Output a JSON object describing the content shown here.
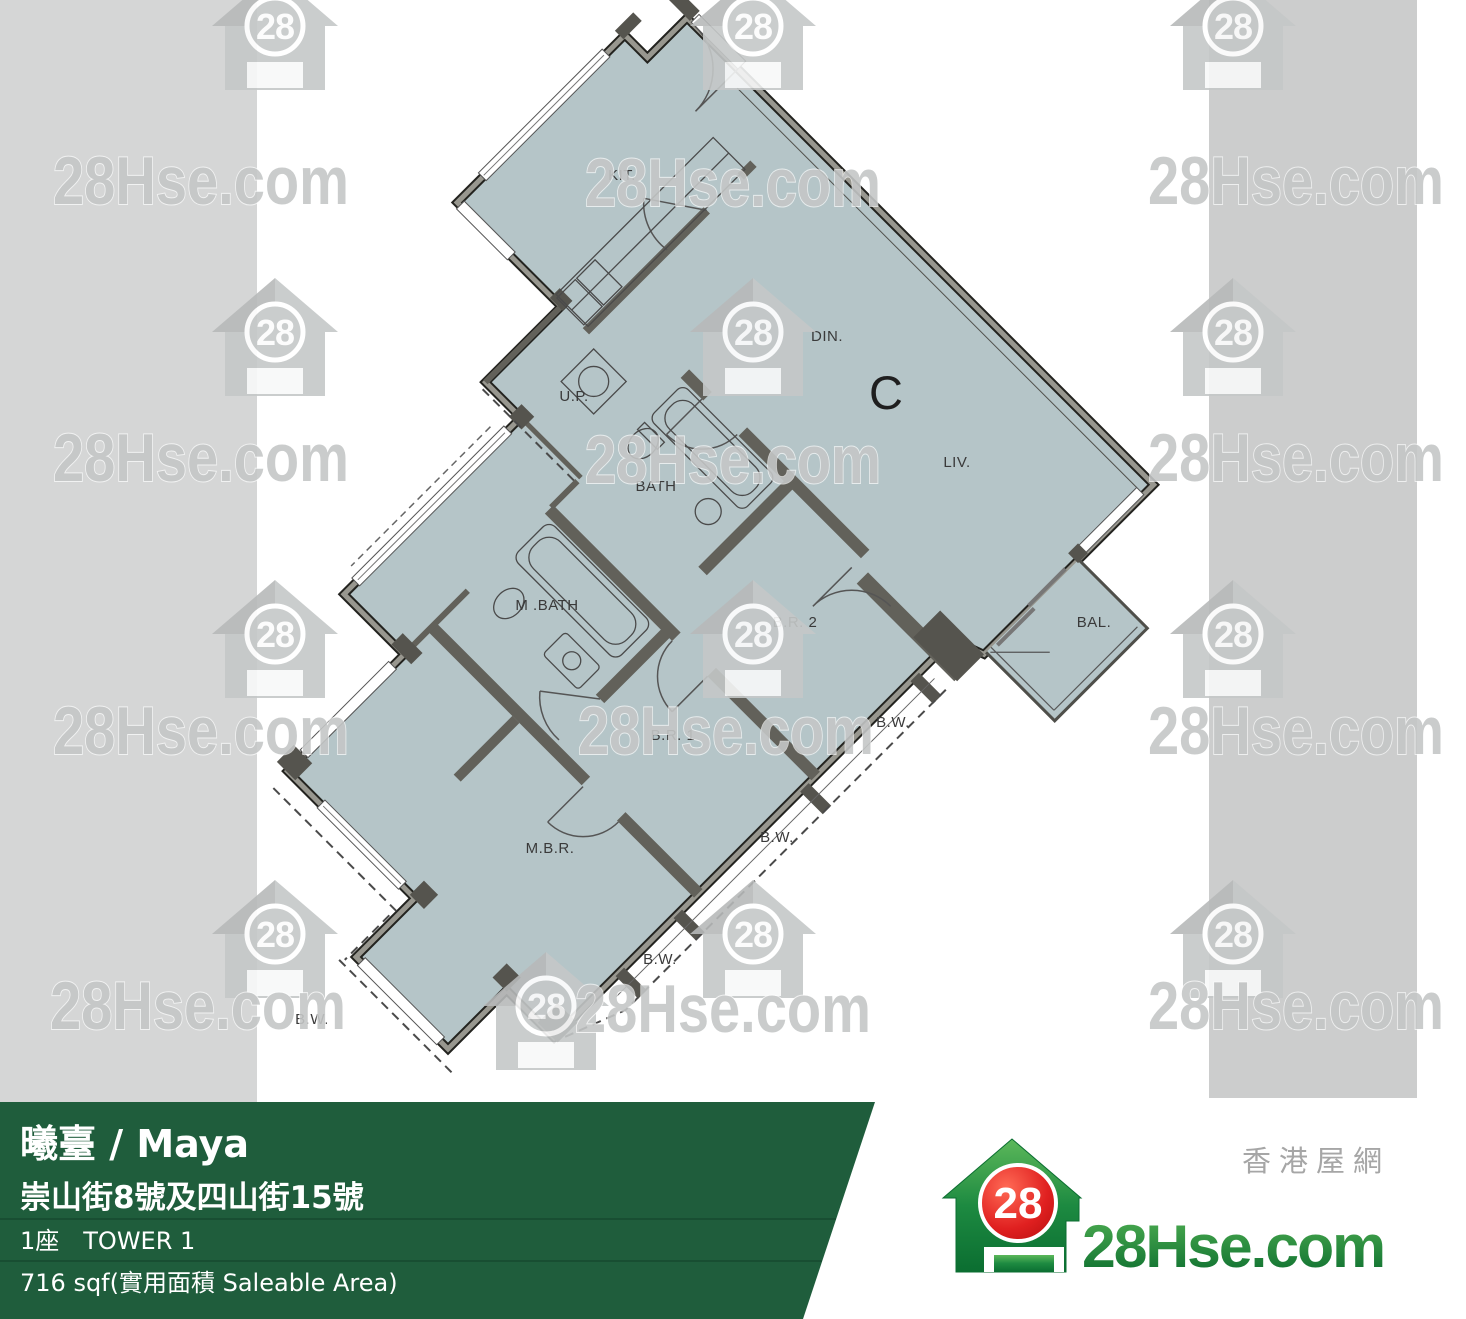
{
  "watermark": {
    "brand": "28Hse.com",
    "badge": "28"
  },
  "plan": {
    "unit": "C",
    "kit": "KIT.",
    "din": "DIN.",
    "liv": "LIV.",
    "up": "U.P.",
    "bath": "BATH",
    "mbath": "M .BATH",
    "br2": "B.R. 2",
    "br1": "B.R. 1",
    "mbr": "M.B.R.",
    "bal": "BAL.",
    "bw": "B.W."
  },
  "footer": {
    "title": "曦臺 / Maya",
    "address": "崇山街8號及四山街15號",
    "tower": "1座　TOWER 1",
    "area": "716 sqf(實用面積 Saleable Area)"
  },
  "logo": {
    "badge": "28",
    "brand": "28Hse.com",
    "tagline": "香港屋網"
  },
  "colors": {
    "footer_green": "#1f5d3c",
    "plan_fill": "#b5c5c8",
    "wall_gray": "#62615a",
    "strip_left": "#d5d6d6",
    "strip_right": "#cccdcd",
    "badge_red": "#d81f1f",
    "logo_green": "#1d8a41"
  }
}
